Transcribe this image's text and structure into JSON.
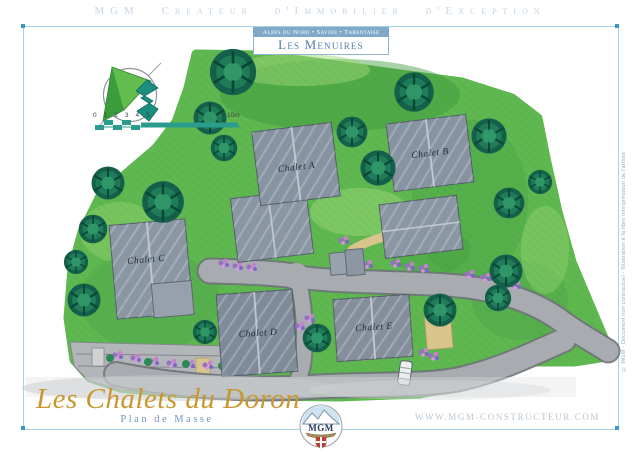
{
  "header": {
    "tagline": "MGM Createur d'Immobilier d'Exception"
  },
  "banner": {
    "region_line": "Alpes du Nord • Savoie • Tarentaise",
    "resort": "Les Menuires"
  },
  "plan": {
    "chalets": [
      {
        "label": "Chalet A"
      },
      {
        "label": "Chalet B"
      },
      {
        "label": "Chalet C"
      },
      {
        "label": "Chalet D"
      },
      {
        "label": "Chalet E"
      }
    ],
    "scale_bar": {
      "ticks": "0 1 2 3 4 5",
      "max_label": "10m"
    }
  },
  "footer": {
    "project_title": "Les Chalets du Doron",
    "subtitle": "Plan de Masse",
    "website": "WWW.MGM-CONSTRUCTEUR.COM",
    "logo_text": "MGM",
    "side_credit": "© MGM - Document non contractuel - Illustration à la libre interprétation de l'artiste"
  },
  "colors": {
    "accent_blue": "#7fa9c9",
    "title_gold": "#c8982f",
    "grass_green": "#5eb74f",
    "tree_green": "#1f7c58",
    "roof_gray": "#8e99a6",
    "road_gray": "#a8acb0",
    "flower_purple": "#9b6fc4",
    "scale_teal": "#2a9c8d"
  }
}
